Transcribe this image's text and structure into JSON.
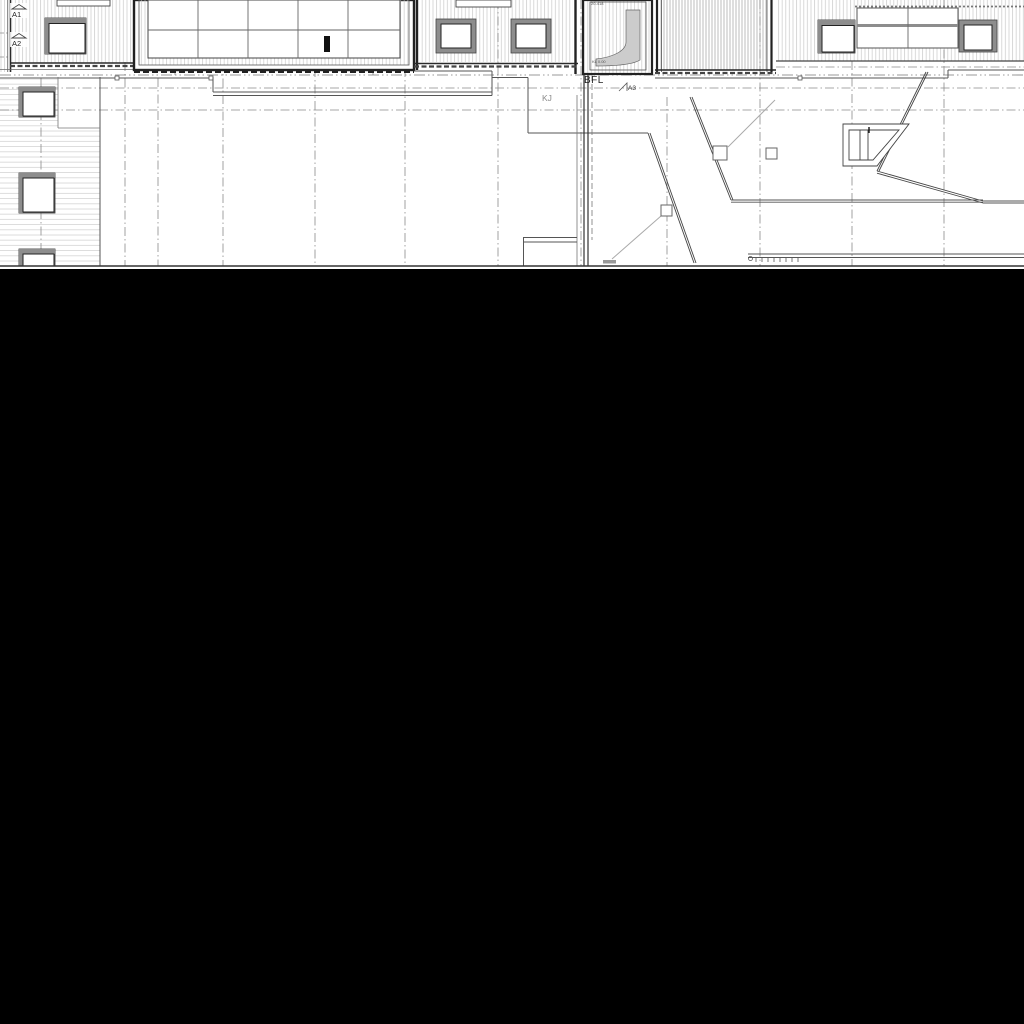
{
  "window": {
    "canvas_background": "#ffffff",
    "void_background": "#000000"
  },
  "drawing": {
    "kind": "architectural-roof-plan",
    "labels": {
      "a1": "A1",
      "a2": "A2",
      "a3": "A3",
      "bfl": "BFL",
      "kj": "KJ",
      "ramp_top": "20-418",
      "ramp_bottom": "KL 0.00"
    },
    "colors": {
      "line_dark": "#2a2a2a",
      "line_mid": "#555555",
      "line_grid": "#8a8a8a",
      "hatch_light": "#cfcfcf",
      "hatch_mid": "#bdbdbd",
      "frame_gray": "#8d8d8d",
      "ramp_fill": "#cccccc"
    }
  }
}
